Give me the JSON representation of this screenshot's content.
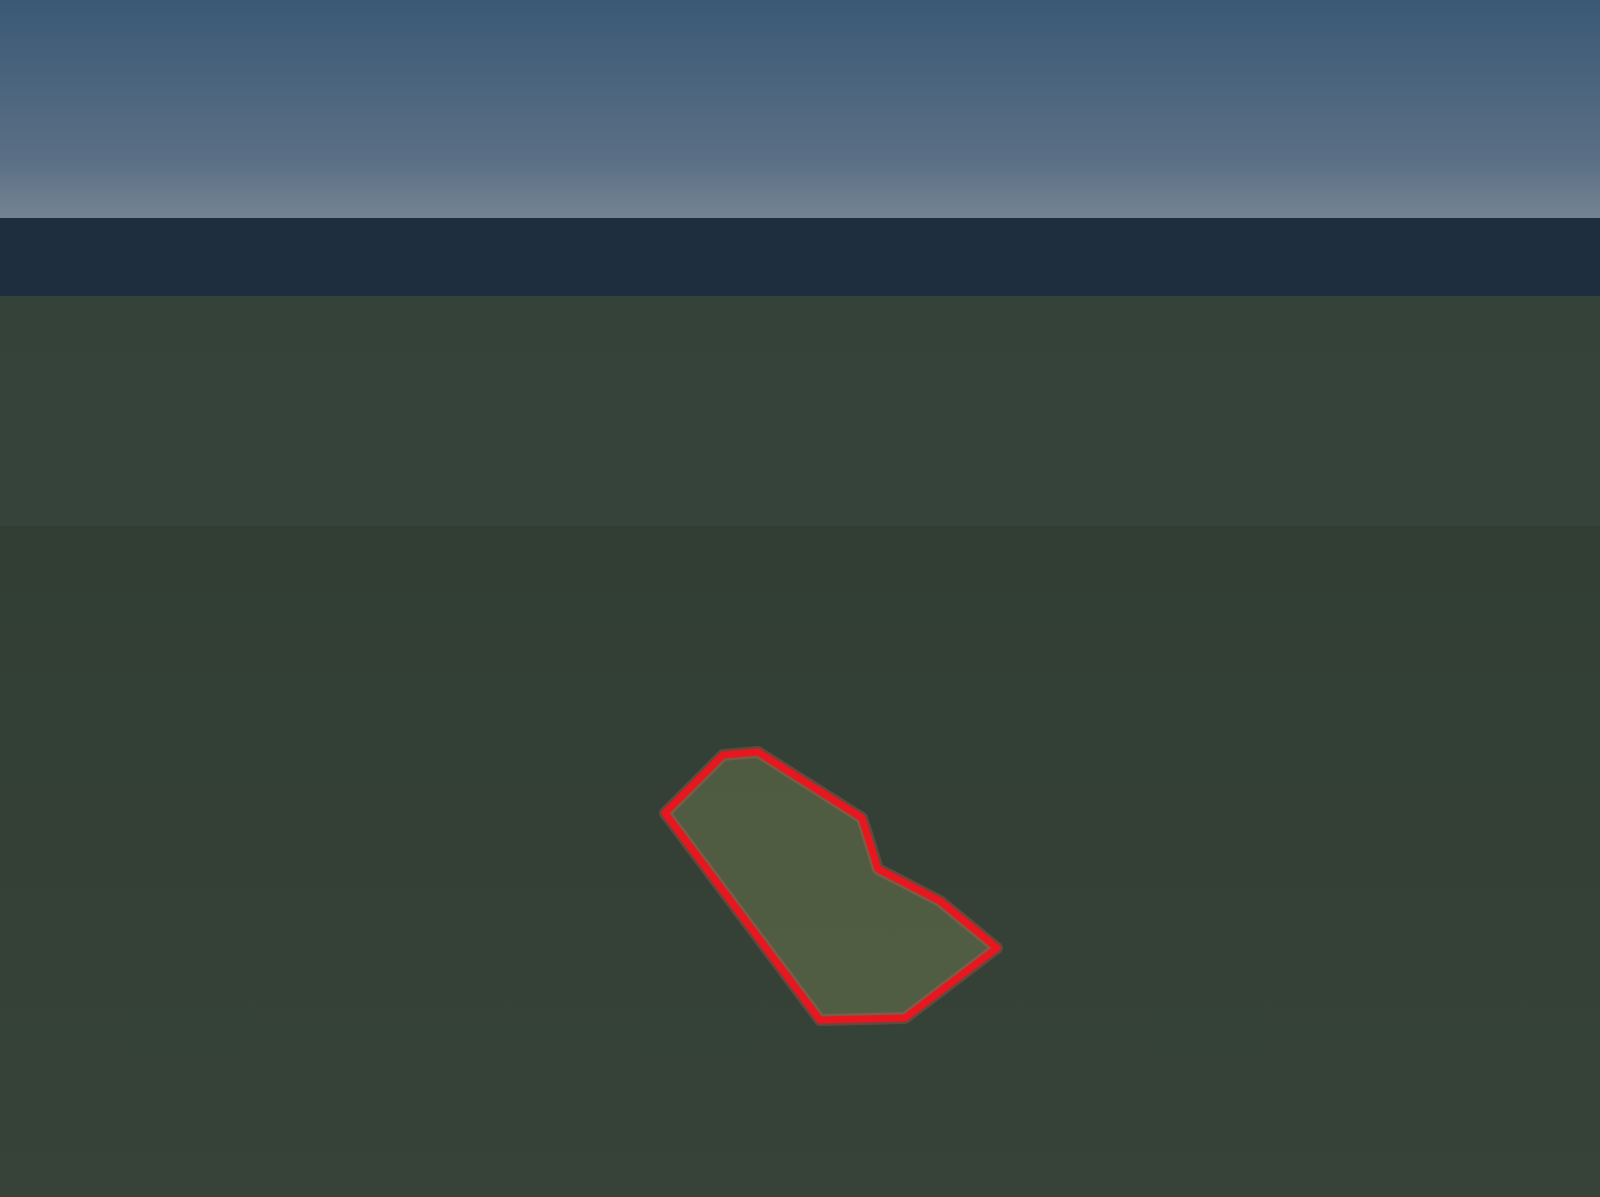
{
  "watermark": {
    "text": "A11902232 © Miami MLS® 2025"
  },
  "colors": {
    "highlight_red": "#e8161f",
    "highlight_red_glow": "#ff5a4f",
    "sky_top": "#5983a9",
    "sky_horizon": "#b7c9d9",
    "cloud_white": "#ffffff",
    "tree_dark": "#33522b",
    "tree_mid": "#47683a",
    "grass_green": "#4a6636",
    "lawn_bright": "#55813a",
    "roof_white": "#d8dde2",
    "wall_white": "#f1f5f8",
    "asphalt_gray": "#6b7076",
    "plaza_gray": "#5d6267",
    "marking_yellow": "#c3a637",
    "pool_teal": "#33a9bd",
    "pergola_blue": "#5d83b3",
    "deck_tan": "#d9cbaa",
    "palm_green": "#4f8c33",
    "dark_overlay": "#0a1524"
  }
}
